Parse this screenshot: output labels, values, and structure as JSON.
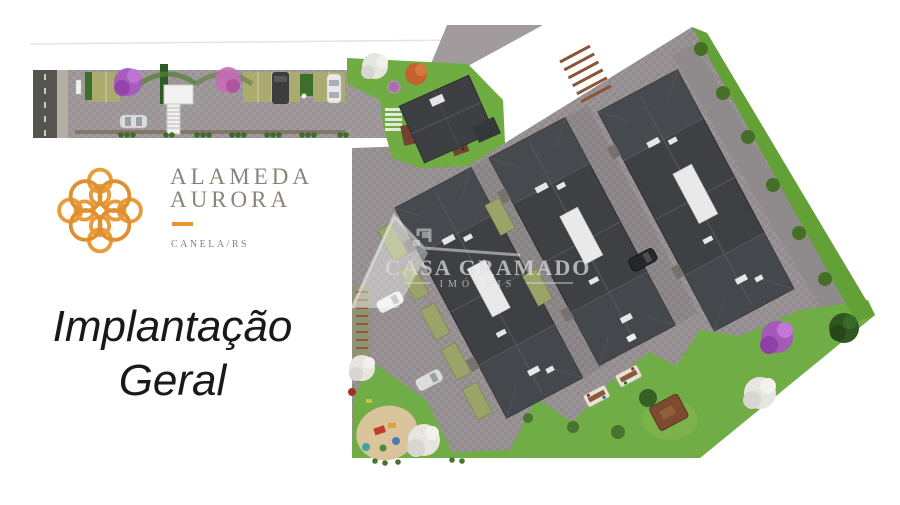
{
  "branding": {
    "name_line1": "ALAMEDA",
    "name_line2": "AURORA",
    "location": "CANELA/RS",
    "logo_icon": "knot-rosette-icon"
  },
  "caption": {
    "line1": "Implantação",
    "line2": "Geral"
  },
  "watermark": {
    "name": "CASA GRAMADO",
    "subtitle": "IMÓVEIS",
    "icon": "house-outline-icon"
  },
  "palette": {
    "accent": "#E8952F",
    "brand-text": "#8B8377",
    "caption-color": "#191919",
    "pavement": "#A19B9E",
    "courtyard": "#949094",
    "asphalt": "#55544E",
    "sidewalk": "#B4AEA2",
    "roof-dark": "#3E4044",
    "roof-light": "#474A4F",
    "lawn": "#6CAA3F",
    "hedge": "#3E6F2A",
    "parking-olive": "#ABAB70",
    "tree-purple": "#A855C0",
    "tree-pink": "#C76BB7",
    "tree-white": "#E7E5E0",
    "tree-orange": "#C3622E",
    "sand": "#D9C49C",
    "wood": "#7D4C30"
  }
}
